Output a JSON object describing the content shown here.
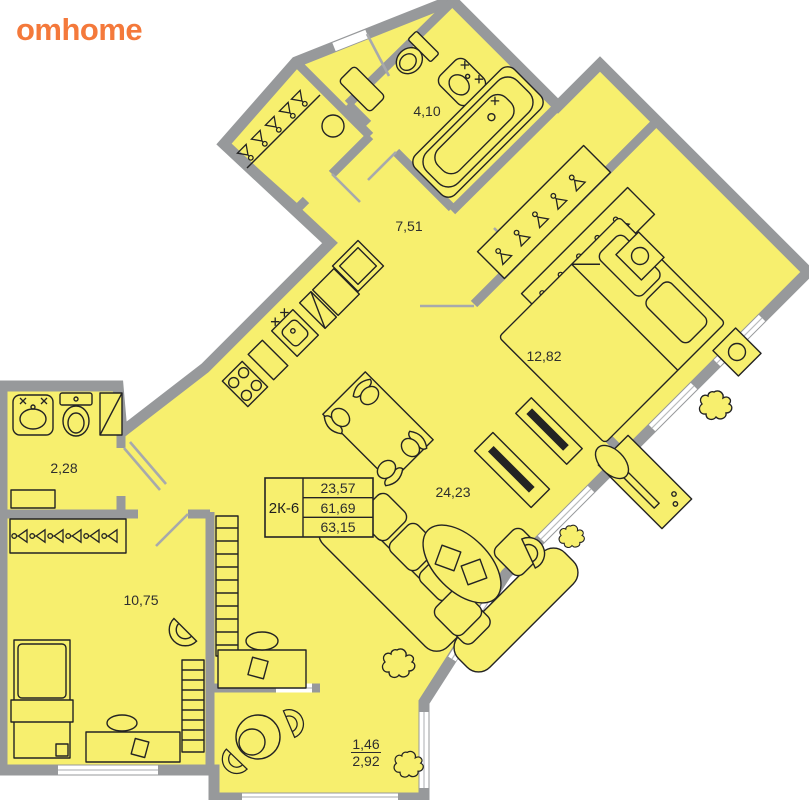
{
  "brand": {
    "logo_text": "omhome",
    "logo_color": "#F4793B"
  },
  "palette": {
    "room_fill": "#F7EF6E",
    "wall_gray": "#97999B",
    "furniture_line": "#232323",
    "label_color": "#2E2E2E",
    "window_white": "#FFFFFF"
  },
  "unit_card": {
    "unit_type": "2К-6",
    "area_rows": [
      "23,57",
      "61,69",
      "63,15"
    ]
  },
  "room_labels": {
    "bathroom_top": "4,10",
    "corridor": "7,51",
    "bedroom": "12,82",
    "living_kitchen": "24,23",
    "bathroom_left": "2,28",
    "room_second": "10,75",
    "balcony_reduced": "1,46",
    "balcony_full": "2,92"
  }
}
